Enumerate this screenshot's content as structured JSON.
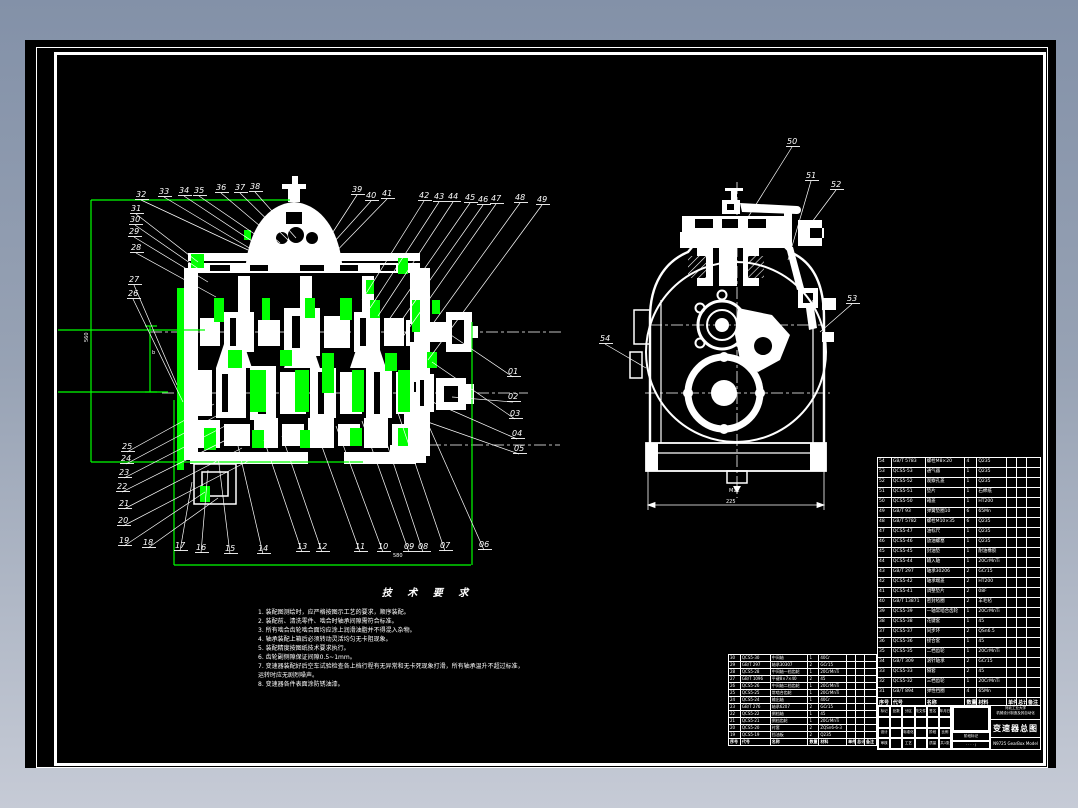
{
  "colors": {
    "highlight_green": "#00ff00",
    "line_white": "#ffffff",
    "paper_black": "#000000",
    "desktop_top": "#8391a8",
    "desktop_bottom": "#c6cbd6"
  },
  "tech": {
    "title": "技 术 要 求",
    "lines": [
      "1. 装配图测绘时，应严格按图示工艺的要求，顺序装配。",
      "2. 装配前、清洗零件、啮合时轴承间隙需符合标准。",
      "3. 所有啮合齿轮啮合面均应涂上润滑油脂并不得混入杂物。",
      "4. 轴承装配上箱后必须转动灵活均匀无卡阻现象。",
      "5. 装配精度按图纸技术要求执行。",
      "6. 齿轮副侧隙保证间隙0.5~1mm。",
      "7. 变速器装配好后空车试验检查各上档行程有无异常和无卡死现象打滑，所有轴承温升不超过标准，",
      "运转时应无剧烈噪声。",
      "8. 变速器各件表面涂防锈油漆。"
    ]
  },
  "dim_texts": [
    {
      "t": "580",
      "x": 393,
      "y": 557,
      "r": 0
    },
    {
      "t": "560",
      "x": 88,
      "y": 342,
      "r": -90
    },
    {
      "t": "225",
      "x": 726,
      "y": 503,
      "r": 0
    },
    {
      "t": "M12",
      "x": 729,
      "y": 492,
      "r": 0
    },
    {
      "t": "b",
      "x": 152,
      "y": 354,
      "r": 0
    }
  ],
  "callouts": [
    {
      "n": "32",
      "lx": 136,
      "ly": 197,
      "tx": 248,
      "ty": 250
    },
    {
      "n": "33",
      "lx": 159,
      "ly": 194,
      "tx": 256,
      "ty": 252
    },
    {
      "n": "34",
      "lx": 179,
      "ly": 193,
      "tx": 264,
      "ty": 249
    },
    {
      "n": "35",
      "lx": 194,
      "ly": 193,
      "tx": 272,
      "ty": 246
    },
    {
      "n": "36",
      "lx": 216,
      "ly": 190,
      "tx": 280,
      "ty": 243
    },
    {
      "n": "37",
      "lx": 235,
      "ly": 190,
      "tx": 288,
      "ty": 240
    },
    {
      "n": "38",
      "lx": 250,
      "ly": 189,
      "tx": 296,
      "ty": 238
    },
    {
      "n": "39",
      "lx": 352,
      "ly": 192,
      "tx": 320,
      "ty": 252
    },
    {
      "n": "40",
      "lx": 366,
      "ly": 198,
      "tx": 316,
      "ty": 262
    },
    {
      "n": "41",
      "lx": 382,
      "ly": 196,
      "tx": 324,
      "ty": 264
    },
    {
      "n": "42",
      "lx": 419,
      "ly": 198,
      "tx": 362,
      "ty": 300
    },
    {
      "n": "43",
      "lx": 434,
      "ly": 199,
      "tx": 370,
      "ty": 308
    },
    {
      "n": "44",
      "lx": 448,
      "ly": 199,
      "tx": 378,
      "ty": 316
    },
    {
      "n": "45",
      "lx": 465,
      "ly": 200,
      "tx": 386,
      "ty": 324
    },
    {
      "n": "46",
      "lx": 478,
      "ly": 202,
      "tx": 394,
      "ty": 331
    },
    {
      "n": "47",
      "lx": 491,
      "ly": 201,
      "tx": 402,
      "ty": 338
    },
    {
      "n": "48",
      "lx": 515,
      "ly": 200,
      "tx": 414,
      "ty": 350
    },
    {
      "n": "49",
      "lx": 537,
      "ly": 202,
      "tx": 428,
      "ty": 360
    },
    {
      "n": "31",
      "lx": 131,
      "ly": 211,
      "tx": 198,
      "ty": 262
    },
    {
      "n": "30",
      "lx": 130,
      "ly": 222,
      "tx": 203,
      "ty": 272
    },
    {
      "n": "29",
      "lx": 129,
      "ly": 234,
      "tx": 208,
      "ty": 282
    },
    {
      "n": "28",
      "lx": 131,
      "ly": 250,
      "tx": 216,
      "ty": 297
    },
    {
      "n": "27",
      "lx": 129,
      "ly": 282,
      "tx": 177,
      "ty": 385
    },
    {
      "n": "26",
      "lx": 128,
      "ly": 296,
      "tx": 183,
      "ty": 402
    },
    {
      "n": "25",
      "lx": 122,
      "ly": 449,
      "tx": 214,
      "ty": 404
    },
    {
      "n": "24",
      "lx": 121,
      "ly": 461,
      "tx": 220,
      "ty": 414
    },
    {
      "n": "23",
      "lx": 119,
      "ly": 475,
      "tx": 227,
      "ty": 425
    },
    {
      "n": "22",
      "lx": 117,
      "ly": 489,
      "tx": 234,
      "ty": 436
    },
    {
      "n": "21",
      "lx": 119,
      "ly": 506,
      "tx": 242,
      "ty": 448
    },
    {
      "n": "20",
      "lx": 118,
      "ly": 523,
      "tx": 250,
      "ty": 460
    },
    {
      "n": "19",
      "lx": 119,
      "ly": 543,
      "tx": 205,
      "ty": 492
    },
    {
      "n": "18",
      "lx": 143,
      "ly": 545,
      "tx": 218,
      "ty": 498
    },
    {
      "n": "17",
      "lx": 175,
      "ly": 548,
      "tx": 192,
      "ty": 482
    },
    {
      "n": "16",
      "lx": 196,
      "ly": 550,
      "tx": 208,
      "ty": 470
    },
    {
      "n": "15",
      "lx": 225,
      "ly": 551,
      "tx": 218,
      "ty": 456
    },
    {
      "n": "14",
      "lx": 258,
      "ly": 551,
      "tx": 238,
      "ty": 446
    },
    {
      "n": "13",
      "lx": 297,
      "ly": 549,
      "tx": 264,
      "ty": 440
    },
    {
      "n": "12",
      "lx": 317,
      "ly": 549,
      "tx": 282,
      "ty": 436
    },
    {
      "n": "11",
      "lx": 355,
      "ly": 549,
      "tx": 316,
      "ty": 430
    },
    {
      "n": "10",
      "lx": 378,
      "ly": 549,
      "tx": 336,
      "ty": 426
    },
    {
      "n": "09",
      "lx": 404,
      "ly": 549,
      "tx": 362,
      "ty": 421
    },
    {
      "n": "08",
      "lx": 418,
      "ly": 549,
      "tx": 378,
      "ty": 417
    },
    {
      "n": "07",
      "lx": 440,
      "ly": 548,
      "tx": 398,
      "ty": 413
    },
    {
      "n": "06",
      "lx": 479,
      "ly": 547,
      "tx": 420,
      "ty": 406
    },
    {
      "n": "01",
      "lx": 508,
      "ly": 374,
      "tx": 448,
      "ty": 333
    },
    {
      "n": "02",
      "lx": 508,
      "ly": 399,
      "tx": 452,
      "ty": 397
    },
    {
      "n": "03",
      "lx": 510,
      "ly": 416,
      "tx": 432,
      "ty": 362
    },
    {
      "n": "04",
      "lx": 512,
      "ly": 436,
      "tx": 428,
      "ty": 400
    },
    {
      "n": "05",
      "lx": 514,
      "ly": 451,
      "tx": 422,
      "ty": 420
    },
    {
      "n": "50",
      "lx": 787,
      "ly": 144,
      "tx": 735,
      "ty": 238
    },
    {
      "n": "51",
      "lx": 806,
      "ly": 178,
      "tx": 788,
      "ty": 260
    },
    {
      "n": "52",
      "lx": 831,
      "ly": 187,
      "tx": 812,
      "ty": 222
    },
    {
      "n": "53",
      "lx": 847,
      "ly": 301,
      "tx": 820,
      "ty": 332
    },
    {
      "n": "54",
      "lx": 600,
      "ly": 341,
      "tx": 646,
      "ty": 368
    }
  ],
  "green": {
    "lines": [
      [
        91,
        200,
        290,
        200
      ],
      [
        91,
        200,
        91,
        462
      ],
      [
        91,
        462,
        363,
        462
      ],
      [
        174,
        400,
        174,
        565
      ],
      [
        174,
        565,
        471,
        565
      ],
      [
        472,
        322,
        472,
        565
      ],
      [
        58,
        330,
        205,
        330
      ],
      [
        58,
        392,
        168,
        392
      ],
      [
        150,
        326,
        150,
        392
      ],
      [
        145,
        326,
        157,
        326
      ],
      [
        145,
        392,
        157,
        392
      ]
    ],
    "rects": [
      [
        177,
        288,
        7,
        182
      ],
      [
        191,
        254,
        6,
        14
      ],
      [
        196,
        254,
        8,
        14
      ],
      [
        214,
        298,
        10,
        24
      ],
      [
        228,
        350,
        14,
        18
      ],
      [
        250,
        370,
        16,
        42
      ],
      [
        262,
        298,
        8,
        22
      ],
      [
        280,
        350,
        12,
        16
      ],
      [
        295,
        370,
        14,
        42
      ],
      [
        305,
        298,
        10,
        20
      ],
      [
        322,
        353,
        12,
        40
      ],
      [
        340,
        298,
        12,
        22
      ],
      [
        352,
        370,
        12,
        42
      ],
      [
        370,
        300,
        10,
        18
      ],
      [
        385,
        353,
        12,
        18
      ],
      [
        398,
        370,
        12,
        42
      ],
      [
        398,
        258,
        10,
        16
      ],
      [
        366,
        280,
        8,
        14
      ],
      [
        412,
        300,
        8,
        32
      ],
      [
        252,
        430,
        12,
        18
      ],
      [
        300,
        430,
        10,
        18
      ],
      [
        350,
        428,
        12,
        18
      ],
      [
        398,
        428,
        10,
        18
      ],
      [
        200,
        486,
        10,
        16
      ],
      [
        204,
        428,
        12,
        22
      ],
      [
        432,
        300,
        8,
        14
      ],
      [
        244,
        230,
        7,
        10
      ],
      [
        427,
        352,
        10,
        16
      ]
    ]
  },
  "parts_table_right": {
    "headers": [
      "序号",
      "代号",
      "名称",
      "数量",
      "材料",
      "单件",
      "总计",
      "备注"
    ],
    "col_widths": [
      14,
      34,
      40,
      12,
      30,
      10,
      10,
      14
    ],
    "rows": [
      [
        "54",
        "GB/T 5783",
        "螺栓M8×20",
        "4",
        "Q235",
        "",
        "",
        ""
      ],
      [
        "53",
        "QCS5-53",
        "通气器",
        "1",
        "Q235",
        "",
        "",
        ""
      ],
      [
        "52",
        "QCS5-52",
        "观察孔盖",
        "1",
        "Q235",
        "",
        "",
        ""
      ],
      [
        "51",
        "QCS5-51",
        "垫片",
        "1",
        "石棉纸",
        "",
        "",
        ""
      ],
      [
        "50",
        "QCS5-50",
        "箱盖",
        "1",
        "HT200",
        "",
        "",
        ""
      ],
      [
        "49",
        "GB/T 93",
        "弹簧垫圈10",
        "6",
        "65Mn",
        "",
        "",
        ""
      ],
      [
        "48",
        "GB/T 5782",
        "螺栓M10×35",
        "6",
        "Q235",
        "",
        "",
        ""
      ],
      [
        "47",
        "QCS5-47",
        "油标尺",
        "1",
        "Q235",
        "",
        "",
        ""
      ],
      [
        "46",
        "QCS5-46",
        "放油螺塞",
        "1",
        "Q235",
        "",
        "",
        ""
      ],
      [
        "45",
        "QCS5-45",
        "封油垫",
        "1",
        "耐油橡胶",
        "",
        "",
        ""
      ],
      [
        "44",
        "QCS5-44",
        "输入轴",
        "1",
        "20CrMnTi",
        "",
        "",
        ""
      ],
      [
        "43",
        "GB/T 297",
        "轴承30206",
        "2",
        "GCr15",
        "",
        "",
        ""
      ],
      [
        "42",
        "QCS5-42",
        "轴承端盖",
        "2",
        "HT200",
        "",
        "",
        ""
      ],
      [
        "41",
        "QCS5-41",
        "调整垫片",
        "2",
        "08F",
        "",
        "",
        ""
      ],
      [
        "40",
        "GB/T 13871",
        "密封毡圈",
        "2",
        "羊毛毡",
        "",
        "",
        ""
      ],
      [
        "39",
        "QCS5-39",
        "一轴常啮合齿轮",
        "1",
        "20CrMnTi",
        "",
        "",
        ""
      ],
      [
        "38",
        "QCS5-38",
        "花键套",
        "1",
        "45",
        "",
        "",
        ""
      ],
      [
        "37",
        "QCS5-37",
        "同步环",
        "2",
        "QSn6.5",
        "",
        "",
        ""
      ],
      [
        "36",
        "QCS5-36",
        "接合套",
        "1",
        "45",
        "",
        "",
        ""
      ],
      [
        "35",
        "QCS5-35",
        "二档齿轮",
        "1",
        "20CrMnTi",
        "",
        "",
        ""
      ],
      [
        "34",
        "GB/T 309",
        "滚针轴承",
        "2",
        "GCr15",
        "",
        "",
        ""
      ],
      [
        "33",
        "QCS5-33",
        "隔套",
        "2",
        "45",
        "",
        "",
        ""
      ],
      [
        "32",
        "QCS5-32",
        "三档齿轮",
        "1",
        "20CrMnTi",
        "",
        "",
        ""
      ],
      [
        "31",
        "GB/T 894",
        "弹性挡圈",
        "4",
        "65Mn",
        "",
        "",
        ""
      ]
    ]
  },
  "parts_table_left": {
    "headers": [
      "序号",
      "代号",
      "名称",
      "数量",
      "材料",
      "单件",
      "总计",
      "备注"
    ],
    "col_widths": [
      12,
      30,
      38,
      11,
      28,
      9,
      9,
      12
    ],
    "rows": [
      [
        "30",
        "QCS5-30",
        "中间轴",
        "1",
        "40Cr",
        "",
        "",
        ""
      ],
      [
        "29",
        "GB/T 297",
        "轴承30307",
        "2",
        "GCr15",
        "",
        "",
        ""
      ],
      [
        "28",
        "QCS5-28",
        "中间轴一档齿轮",
        "1",
        "20CrMnTi",
        "",
        "",
        ""
      ],
      [
        "27",
        "GB/T 1096",
        "平键8×7×40",
        "2",
        "45",
        "",
        "",
        ""
      ],
      [
        "26",
        "QCS5-26",
        "中间轴二档齿轮",
        "1",
        "20CrMnTi",
        "",
        "",
        ""
      ],
      [
        "25",
        "QCS5-25",
        "常啮合齿轮",
        "1",
        "20CrMnTi",
        "",
        "",
        ""
      ],
      [
        "24",
        "QCS5-24",
        "输出轴",
        "1",
        "40Cr",
        "",
        "",
        ""
      ],
      [
        "23",
        "GB/T 276",
        "轴承6207",
        "2",
        "GCr15",
        "",
        "",
        ""
      ],
      [
        "22",
        "QCS5-22",
        "倒档轴",
        "1",
        "45",
        "",
        "",
        ""
      ],
      [
        "21",
        "QCS5-21",
        "倒档齿轮",
        "1",
        "20CrMnTi",
        "",
        "",
        ""
      ],
      [
        "20",
        "QCS5-20",
        "衬套",
        "2",
        "ZQSn6-6-3",
        "",
        "",
        ""
      ],
      [
        "19",
        "QCS5-19",
        "挡油板",
        "2",
        "Q235",
        "",
        "",
        ""
      ]
    ]
  },
  "title_block": {
    "sig_row1": [
      "标记",
      "处数",
      "分区",
      "更改文件号",
      "签名",
      "年月日"
    ],
    "sig_row2": [
      "",
      "",
      "",
      "",
      "",
      ""
    ],
    "sig_row3": [
      "设计",
      "",
      "标准化",
      "",
      "阶段",
      "比例"
    ],
    "sig_row4": [
      "审核",
      "",
      "工艺",
      "",
      "质量",
      "共1张"
    ],
    "stage_label": "阶段标记",
    "stage_marks": "· · · ·  /",
    "org_line1": "河北工业大学",
    "org_line2": "机械设计制造及其自动化",
    "drawing_title": "变速器总图",
    "footer": "N9725 GearBox Model"
  }
}
